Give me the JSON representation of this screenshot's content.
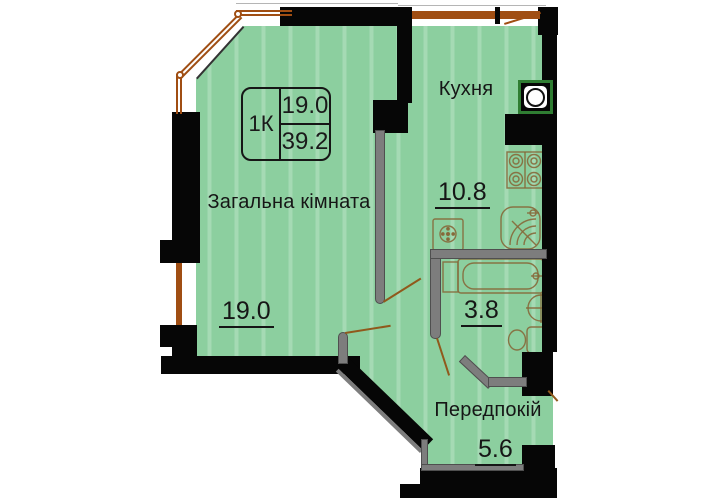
{
  "plan_title": "1K apartment floor plan",
  "info_box": {
    "type_label": "1К",
    "room_area": "19.0",
    "total_area": "39.2"
  },
  "rooms": {
    "living": {
      "name": "Загальна кімната",
      "area": "19.0"
    },
    "kitchen": {
      "name": "Кухня",
      "area": "10.8"
    },
    "bathroom": {
      "area": "3.8"
    },
    "hallway": {
      "name": "Передпокій",
      "area": "5.6"
    }
  },
  "icons": {
    "ventilation": "ventilation-shaft",
    "stove": "stove-4-burners",
    "kitchen_sink": "corner-sink",
    "washing_machine": "washing-machine",
    "bathtub": "bathtub",
    "wash_basin": "wash-basin",
    "toilet": "toilet"
  },
  "colors": {
    "background": "#FFFFFF",
    "floor_green": "#8CCF9F",
    "wall_black": "#060606",
    "partition_gray": "#7D7D7D",
    "window_brown": "#A04E13",
    "door_brown": "#90591C",
    "fixture_outline": "#86683A",
    "vent_frame_green": "#2F7D32",
    "text": "#161616"
  }
}
